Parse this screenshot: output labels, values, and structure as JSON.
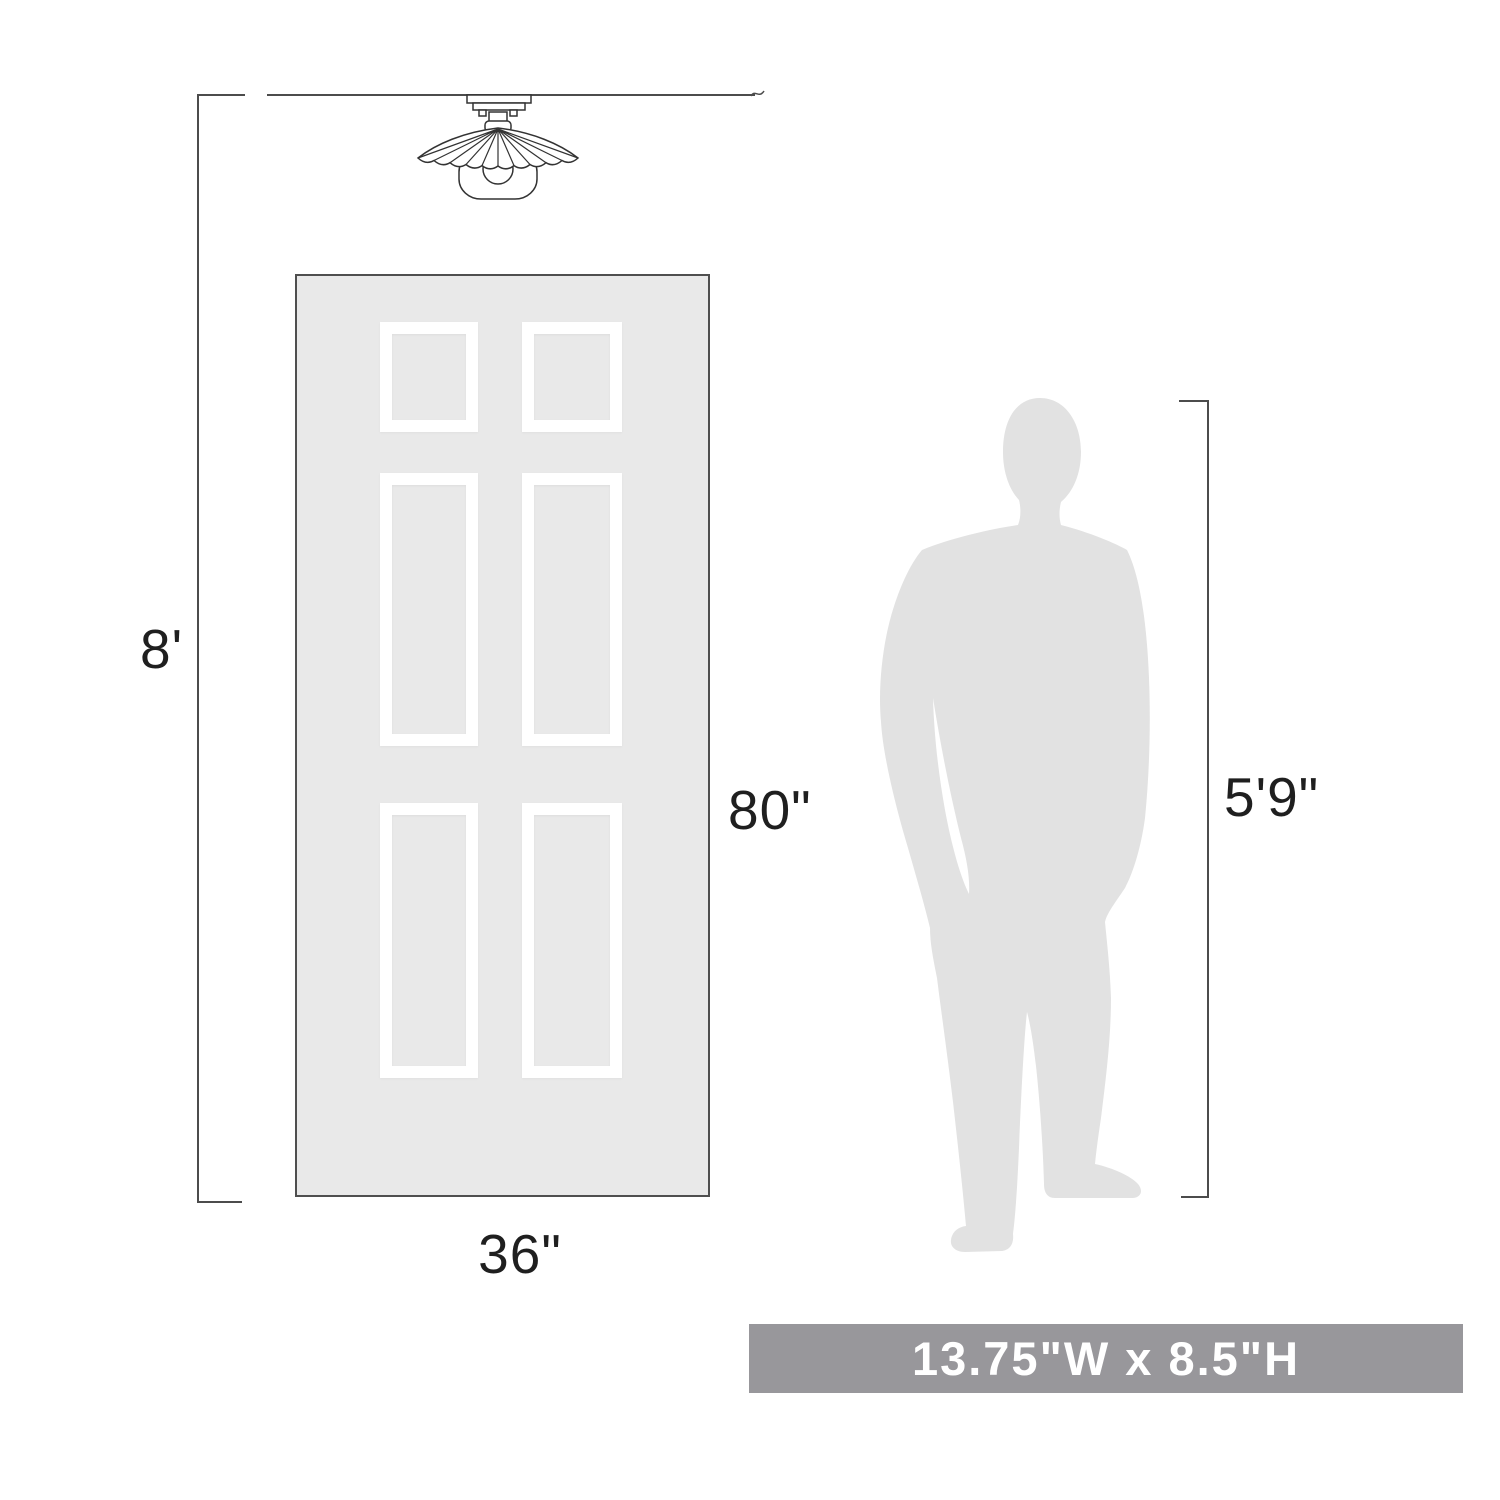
{
  "diagram": {
    "type": "product-scale-diagram",
    "labels": {
      "ceiling_height": "8'",
      "door_height": "80\"",
      "door_width": "36\"",
      "person_height": "5'9\""
    },
    "banner": {
      "text": "13.75\"W x 8.5\"H",
      "background": "#98979B",
      "text_color": "#FFFFFF"
    },
    "colors": {
      "door_fill": "#E9E9E9",
      "door_border": "#4F4F4F",
      "panel_frame": "#FFFFFF",
      "silhouette": "#E2E2E2",
      "dimension_line": "#4C4C4C",
      "label_text": "#1F1F1F",
      "fixture_outline": "#333333",
      "background": "#FFFFFF"
    },
    "icons": {
      "light_fixture": "flush-mount-scalloped-light-icon",
      "person": "man-silhouette-icon"
    }
  }
}
